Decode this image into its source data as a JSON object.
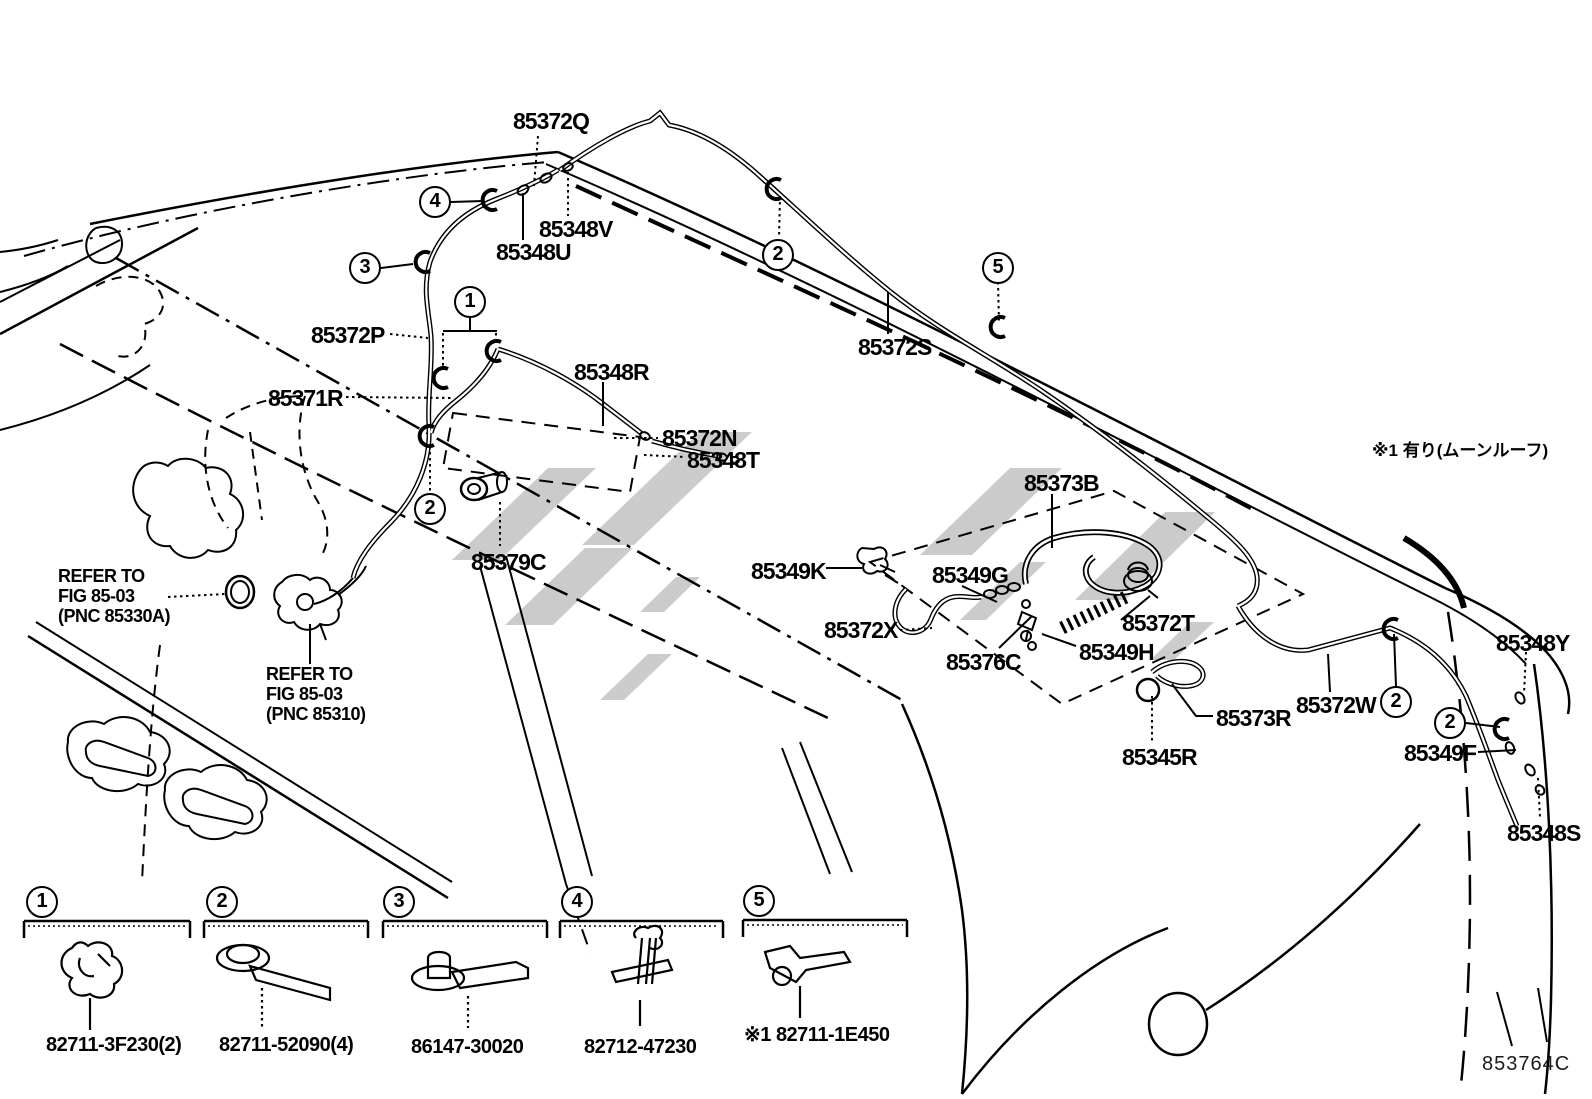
{
  "meta": {
    "figure_code": "853764C",
    "note_moonroof": "※1 有り(ムーンルーフ)",
    "watermark_icon": "gray-logo-watermark"
  },
  "parts": {
    "p85372q": "85372Q",
    "p85348v": "85348V",
    "p85348u": "85348U",
    "p85372p": "85372P",
    "p85371r": "85371R",
    "p85348r": "85348R",
    "p85372n": "85372N",
    "p85348t": "85348T",
    "p85372s": "85372S",
    "p85379c": "85379C",
    "p85349k": "85349K",
    "p85349g": "85349G",
    "p85373b": "85373B",
    "p85372x": "85372X",
    "p85376c": "85376C",
    "p85349h": "85349H",
    "p85372t": "85372T",
    "p85373r": "85373R",
    "p85345r": "85345R",
    "p85372w": "85372W",
    "p85348y": "85348Y",
    "p85349f": "85349F",
    "p85348s": "85348S"
  },
  "refer_fig_85330a": {
    "l1": "REFER TO",
    "l2": "FIG 85-03",
    "l3": "(PNC 85330A)"
  },
  "refer_fig_85310": {
    "l1": "REFER TO",
    "l2": "FIG 85-03",
    "l3": "(PNC 85310)"
  },
  "callouts": {
    "n1": "1",
    "n2": "2",
    "n3": "3",
    "n4": "4",
    "n5": "5"
  },
  "legend": {
    "items": [
      {
        "num": "1",
        "part": "82711-3F230(2)"
      },
      {
        "num": "2",
        "part": "82711-52090(4)"
      },
      {
        "num": "3",
        "part": "86147-30020"
      },
      {
        "num": "4",
        "part": "82712-47230"
      },
      {
        "num": "5",
        "part": "※1 82711-1E450"
      }
    ]
  }
}
